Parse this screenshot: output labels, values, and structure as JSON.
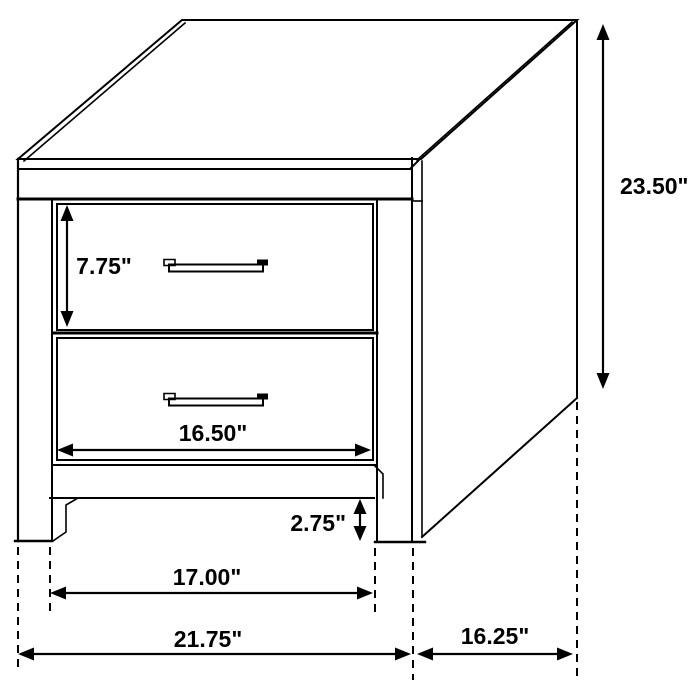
{
  "dimensions": {
    "overall_height": "23.50\"",
    "drawer_height": "7.75\"",
    "drawer_width": "16.50\"",
    "base_clearance": "2.75\"",
    "inner_width": "17.00\"",
    "overall_width": "21.75\"",
    "overall_depth": "16.25\""
  }
}
